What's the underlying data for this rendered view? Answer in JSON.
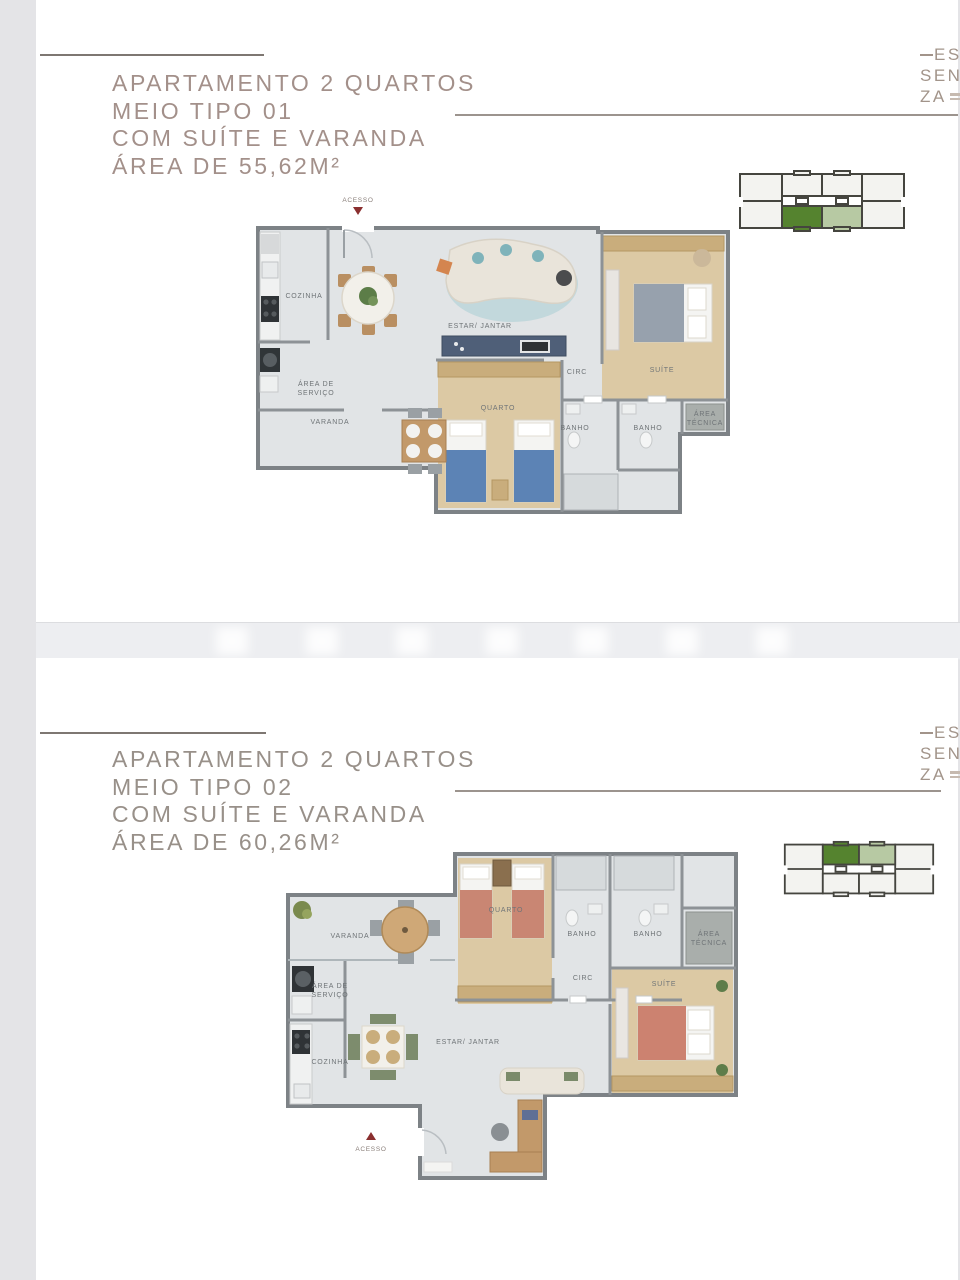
{
  "page": {
    "bg_color": "#e4e4e7",
    "card_color": "#ffffff"
  },
  "logo": {
    "line1": "ES",
    "line2": "SEN",
    "line3": "ZA"
  },
  "colors": {
    "title_text": "#a3908a",
    "rule_line": "#7e7772",
    "keyplan_dark_green": "#55832f",
    "keyplan_light_green": "#b7c9a3",
    "keyplan_outline": "#45453f",
    "plan_wall": "#7d8286",
    "plan_tile_floor": "#e1e4e6",
    "plan_wood_floor": "#dcc9a4",
    "access_marker_red": "#8a2f2f"
  },
  "sections": [
    {
      "title_line1": "APARTAMENTO 2 QUARTOS",
      "title_line2": "MEIO TIPO 01",
      "title_line3": "COM SUÍTE E VARANDA",
      "title_line4": "ÁREA DE 55,62M²",
      "keyplan_highlight": "bottom-center units",
      "labels": {
        "acesso": "ACESSO",
        "cozinha": "COZINHA",
        "estar_jantar": "ESTAR/ JANTAR",
        "area_de": "ÁREA DE",
        "servico": "SERVIÇO",
        "varanda": "VARANDA",
        "quarto": "QUARTO",
        "banho_a": "BANHO",
        "banho_b": "BANHO",
        "circ": "CIRC",
        "suite": "SUÍTE",
        "area": "ÁREA",
        "tecnica": "TÉCNICA"
      }
    },
    {
      "title_line1": "APARTAMENTO 2 QUARTOS",
      "title_line2": "MEIO TIPO 02",
      "title_line3": "COM SUÍTE E VARANDA",
      "title_line4": "ÁREA DE 60,26M²",
      "keyplan_highlight": "top-center units",
      "labels": {
        "acesso": "ACESSO",
        "cozinha": "COZINHA",
        "estar_jantar": "ESTAR/ JANTAR",
        "area_de": "ÁREA DE",
        "servico": "SERVIÇO",
        "varanda": "VARANDA",
        "quarto": "QUARTO",
        "banho_a": "BANHO",
        "banho_b": "BANHO",
        "circ": "CIRC",
        "suite": "SUÍTE",
        "area": "ÁREA",
        "tecnica": "TÉCNICA"
      }
    }
  ]
}
